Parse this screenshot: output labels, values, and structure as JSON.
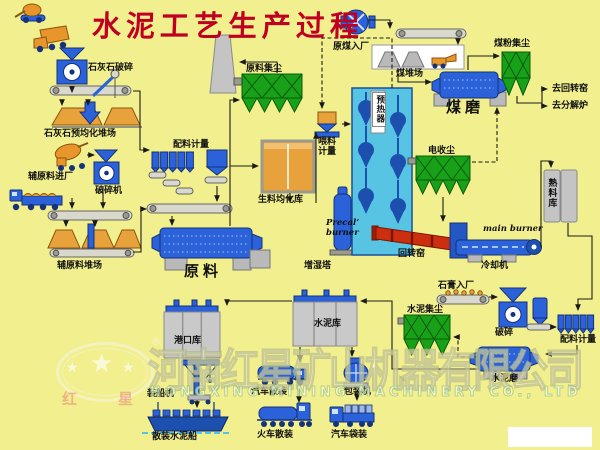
{
  "title": "水泥工艺生产过程",
  "labels": {
    "limestone_crushing": "石灰石破碎",
    "limestone_preblending_yard": "石灰石预均化堆场",
    "aux_material_entry": "辅原料进厂",
    "crusher": "破碎机",
    "aux_material_yard": "辅原料堆场",
    "batching_metering": "配料计量",
    "raw_mill": "原料",
    "raw_dust_collector": "原料集尘",
    "raw_meal_homogenizing_silo": "生料均化库",
    "feeding_metering": "喂料\n计量",
    "humidifying_tower": "增湿塔",
    "precal_burner": "Precal’\nburner",
    "preheater": "预热器",
    "raw_coal_entry": "原煤入厂",
    "coal_yard": "煤堆场",
    "coal_dust_collector": "煤粉集尘",
    "coal_mill": "煤磨",
    "to_rotary_kiln": "去回转窑",
    "to_calciner": "去分解炉",
    "electrostatic_precipitator": "电收尘",
    "clinker_silo": "熟料库",
    "main_burner": "main burner",
    "rotary_kiln": "回转窑",
    "cooler": "冷却机",
    "gypsum_entry": "石膏入厂",
    "gypsum_crushing": "破碎",
    "batching_metering_2": "配料计量",
    "cement_dust_collector": "水泥集尘",
    "cement_mill": "水泥磨",
    "cement_silo": "水泥库",
    "port_silo": "港口库",
    "ship_loader": "装船机",
    "bulk_cement_ship": "散装水泥船",
    "truck_bulk_loading": "汽车散装",
    "train_bulk_loading": "火车散装",
    "packing_machine": "包装机",
    "truck_bag_loading": "汽车袋装"
  },
  "watermark": {
    "company_cn": "河南红星矿山机器有限公司",
    "company_en": "HONGXING MINING MACHINERY CO., LTD",
    "logo_char_left": "红",
    "logo_char_right": "星",
    "registered_mark": "®"
  },
  "colors": {
    "background": "#f2ef8e",
    "title_red": "#c00022",
    "machine_blue": "#2b62d9",
    "dust_collector_green": "#18a018",
    "kiln_red": "#ce2e10",
    "material_orange": "#e8a23c",
    "silo_grey": "#c4c4c4"
  }
}
